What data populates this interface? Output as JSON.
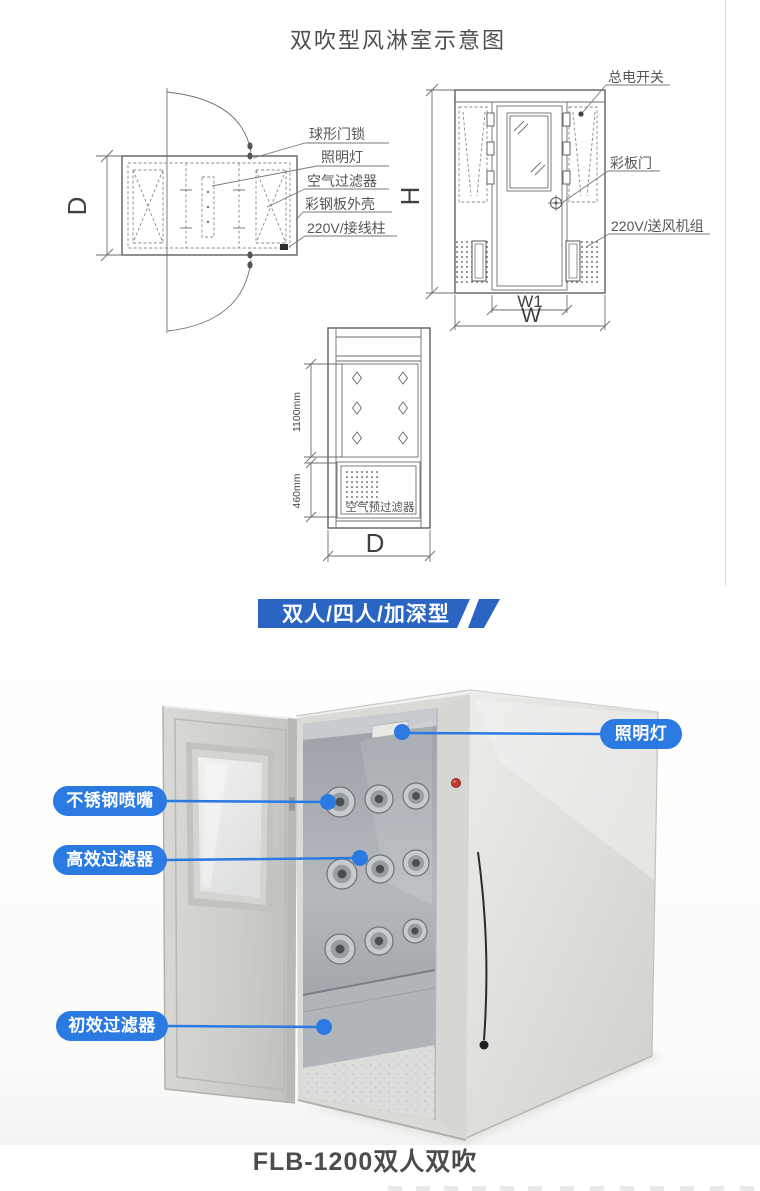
{
  "schematic": {
    "title": "双吹型风淋室示意图",
    "plan_view": {
      "callouts": [
        "球形门锁",
        "照明灯",
        "空气过滤器",
        "彩钢板外壳",
        "220V/接线柱"
      ],
      "dim_depth": "D"
    },
    "front_view": {
      "callouts": [
        "总电开关",
        "彩板门",
        "220V/送风机组"
      ],
      "dim_height": "H",
      "dim_door_width": "W1",
      "dim_width": "W"
    },
    "side_view": {
      "panel_label": "空气预过滤器",
      "dim_upper": "1100mm",
      "dim_lower": "460mm",
      "dim_depth": "D"
    }
  },
  "banner": {
    "text": "双人/四人/加深型",
    "color": "#2a65c4"
  },
  "product": {
    "callout_color": "#2b7ae2",
    "indicator_color": "#c23b2e",
    "callouts": {
      "light": "照明灯",
      "nozzle": "不锈钢喷嘴",
      "hepa": "高效过滤器",
      "prefilter": "初效过滤器"
    },
    "caption": "FLB-1200双人双吹"
  }
}
